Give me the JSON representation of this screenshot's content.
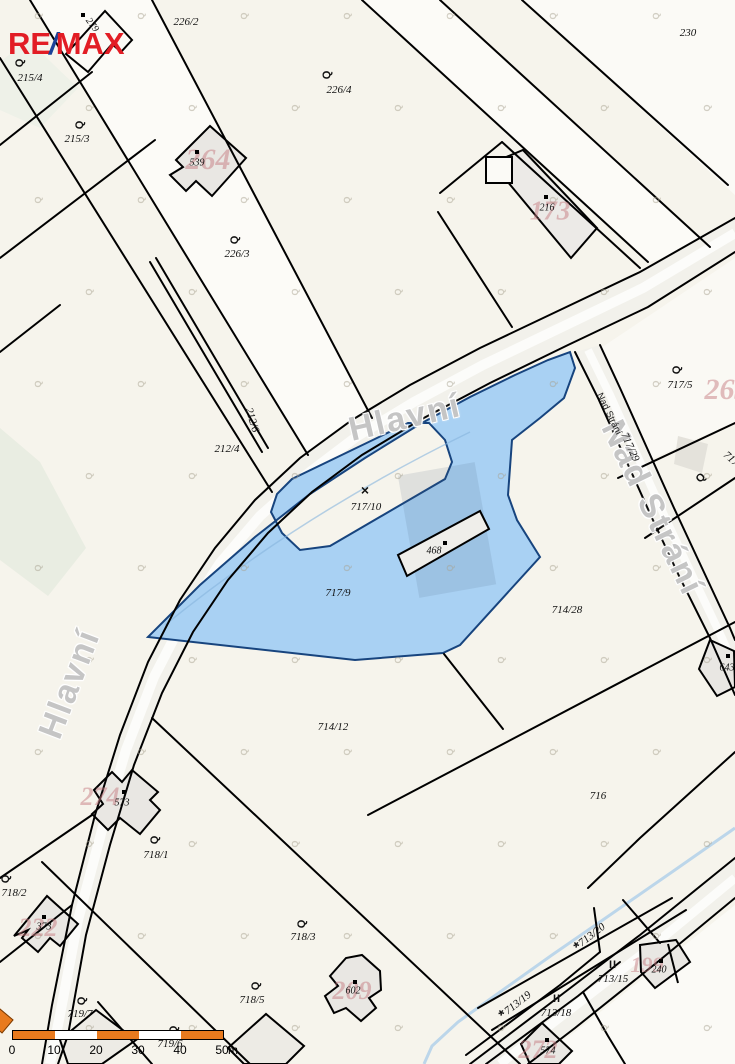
{
  "logo": {
    "part1": "RE",
    "slash": "/",
    "part2": "MAX"
  },
  "colors": {
    "highlight_fill": "#a9d1f3",
    "highlight_stroke": "#17447e",
    "ghost_pink": "#c97f86",
    "scale_orange": "#e87a1e",
    "road_fill": "#f2f1eb",
    "street_gray": "#c5c5c5"
  },
  "streets": [
    {
      "text": "Hlavní",
      "x": 405,
      "y": 418,
      "rot": -13,
      "kind": "major"
    },
    {
      "text": "Hlavní",
      "x": 70,
      "y": 684,
      "rot": -69,
      "kind": "major"
    },
    {
      "text": "Nad Strání",
      "x": 652,
      "y": 508,
      "rot": 64,
      "kind": "major"
    },
    {
      "text": "Nad Strání",
      "x": 609,
      "y": 414,
      "rot": 64,
      "kind": "minor"
    }
  ],
  "parcel_labels": [
    {
      "text": "226/2",
      "x": 186,
      "y": 22,
      "rot": 0
    },
    {
      "text": "226/4",
      "x": 339,
      "y": 90,
      "rot": 0,
      "symbol": "garden",
      "sx": 327,
      "sy": 75,
      "srot": -90
    },
    {
      "text": "226/3",
      "x": 237,
      "y": 254,
      "rot": 0,
      "symbol": "garden",
      "sx": 235,
      "sy": 240,
      "srot": -88
    },
    {
      "text": "215/4",
      "x": 30,
      "y": 78,
      "rot": 0,
      "symbol": "garden",
      "sx": 20,
      "sy": 63,
      "srot": -88
    },
    {
      "text": "215/3",
      "x": 77,
      "y": 139,
      "rot": 0,
      "symbol": "garden",
      "sx": 80,
      "sy": 125,
      "srot": -88
    },
    {
      "text": "230",
      "x": 688,
      "y": 33,
      "rot": 0
    },
    {
      "text": "212/6",
      "x": 252,
      "y": 420,
      "rot": 73
    },
    {
      "text": "212/4",
      "x": 227,
      "y": 449,
      "rot": 0
    },
    {
      "text": "717/10",
      "x": 366,
      "y": 507,
      "rot": 0,
      "symbol": "ruin",
      "sx": 365,
      "sy": 490,
      "srot": 0
    },
    {
      "text": "717/9",
      "x": 338,
      "y": 593,
      "rot": 0
    },
    {
      "text": "717/5",
      "x": 680,
      "y": 385,
      "rot": 0,
      "symbol": "garden",
      "sx": 677,
      "sy": 370,
      "srot": -88
    },
    {
      "text": "717/29",
      "x": 630,
      "y": 447,
      "rot": 66
    },
    {
      "text": "717",
      "x": 731,
      "y": 459,
      "rot": 42
    },
    {
      "text": "714/28",
      "x": 567,
      "y": 610,
      "rot": 0
    },
    {
      "text": "714/12",
      "x": 333,
      "y": 727,
      "rot": 0
    },
    {
      "text": "716",
      "x": 598,
      "y": 796,
      "rot": 0
    },
    {
      "text": "718/1",
      "x": 156,
      "y": 855,
      "rot": 0,
      "symbol": "garden",
      "sx": 155,
      "sy": 840,
      "srot": -88
    },
    {
      "text": "718/2",
      "x": 14,
      "y": 893,
      "rot": 0,
      "symbol": "garden",
      "sx": 6,
      "sy": 879,
      "srot": -88
    },
    {
      "text": "718/3",
      "x": 303,
      "y": 937,
      "rot": 0,
      "symbol": "garden",
      "sx": 302,
      "sy": 924,
      "srot": -88
    },
    {
      "text": "718/5",
      "x": 252,
      "y": 1000,
      "rot": 0,
      "symbol": "garden",
      "sx": 256,
      "sy": 986,
      "srot": -88
    },
    {
      "text": "719/7",
      "x": 80,
      "y": 1014,
      "rot": 0,
      "symbol": "garden",
      "sx": 82,
      "sy": 1001,
      "srot": -88
    },
    {
      "text": "719/6",
      "x": 170,
      "y": 1044,
      "rot": 0,
      "symbol": "garden",
      "sx": 174,
      "sy": 1030,
      "srot": -88
    },
    {
      "text": "713/20",
      "x": 592,
      "y": 935,
      "rot": -38,
      "symbol": "orchard",
      "sx": 578,
      "sy": 947,
      "srot": -38
    },
    {
      "text": "713/19",
      "x": 518,
      "y": 1003,
      "rot": -38,
      "symbol": "orchard",
      "sx": 503,
      "sy": 1015,
      "srot": -38
    },
    {
      "text": "713/18",
      "x": 556,
      "y": 1013,
      "rot": 0,
      "symbol": "meadow",
      "sx": 557,
      "sy": 999,
      "srot": 0
    },
    {
      "text": "713/15",
      "x": 613,
      "y": 979,
      "rot": 0,
      "symbol": "meadow",
      "sx": 613,
      "sy": 965,
      "srot": 0
    }
  ],
  "lone_symbols": [
    {
      "kind": "garden",
      "x": 701,
      "y": 478,
      "rot": -50
    }
  ],
  "building_labels": [
    {
      "text": "539",
      "x": 197,
      "y": 163,
      "rot": 0,
      "dx": 197,
      "dy": 152
    },
    {
      "text": "279",
      "x": 92,
      "y": 25,
      "rot": 53,
      "dx": 83,
      "dy": 15
    },
    {
      "text": "216",
      "x": 547,
      "y": 208,
      "rot": 0,
      "dx": 546,
      "dy": 197
    },
    {
      "text": "468",
      "x": 434,
      "y": 551,
      "rot": 0,
      "dx": 445,
      "dy": 543
    },
    {
      "text": "573",
      "x": 122,
      "y": 803,
      "rot": 0,
      "dx": 124,
      "dy": 792
    },
    {
      "text": "373",
      "x": 44,
      "y": 927,
      "rot": 0,
      "dx": 44,
      "dy": 917
    },
    {
      "text": "602",
      "x": 353,
      "y": 991,
      "rot": 0,
      "dx": 355,
      "dy": 982
    },
    {
      "text": "240",
      "x": 659,
      "y": 970,
      "rot": 0,
      "dx": 661,
      "dy": 961
    },
    {
      "text": "574",
      "x": 548,
      "y": 1051,
      "rot": 0,
      "dx": 547,
      "dy": 1040
    },
    {
      "text": "643",
      "x": 727,
      "y": 668,
      "rot": 0,
      "dx": 728,
      "dy": 656
    }
  ],
  "ghost_numbers": [
    {
      "text": "264",
      "x": 208,
      "y": 160,
      "size": 30
    },
    {
      "text": "173",
      "x": 550,
      "y": 211,
      "size": 27
    },
    {
      "text": "263",
      "x": 727,
      "y": 390,
      "size": 30
    },
    {
      "text": "274",
      "x": 100,
      "y": 797,
      "size": 26
    },
    {
      "text": "222",
      "x": 38,
      "y": 928,
      "size": 26
    },
    {
      "text": "209",
      "x": 352,
      "y": 991,
      "size": 26
    },
    {
      "text": "199",
      "x": 647,
      "y": 965,
      "size": 22
    },
    {
      "text": "272",
      "x": 538,
      "y": 1050,
      "size": 26
    }
  ],
  "scale_bar": {
    "ticks": [
      "0",
      "10",
      "20",
      "30",
      "40",
      "50"
    ],
    "unit": "m"
  }
}
